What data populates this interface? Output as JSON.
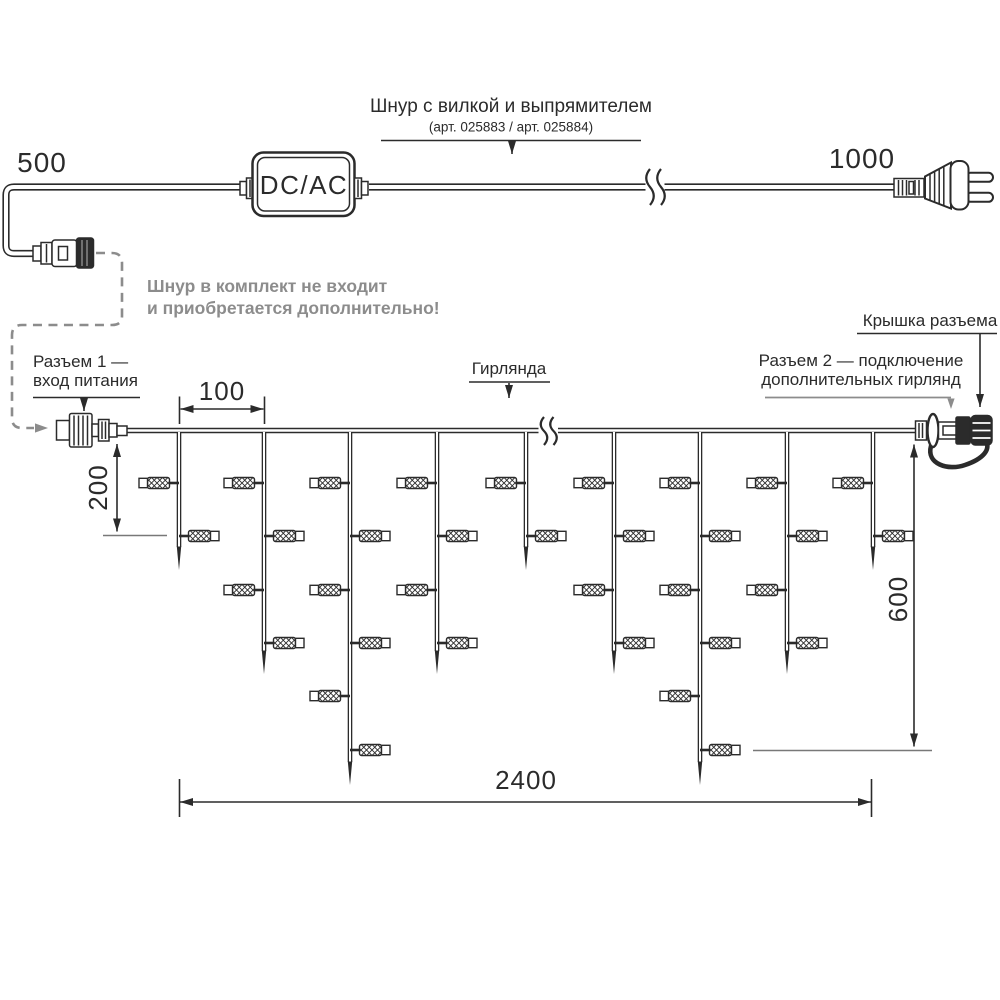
{
  "colors": {
    "ink": "#2b2b2b",
    "gray": "#8c8c8c",
    "extension_gray": "#787878",
    "background": "#ffffff"
  },
  "power_cord": {
    "length_left": "500",
    "length_right": "1000",
    "converter_label": "DC/AC",
    "title": "Шнур с вилкой и выпрямителем",
    "article": "(арт. 025883 / арт. 025884)",
    "note_line1": "Шнур в комплект не входит",
    "note_line2": "и приобретается дополнительно!"
  },
  "labels": {
    "connector1_line1": "Разъем 1 —",
    "connector1_line2": "вход питания",
    "garland": "Гирлянда",
    "connector2_line1": "Разъем 2 — подключение",
    "connector2_line2": "дополнительных гирлянд",
    "connector_cap": "Крышка разъема"
  },
  "dimensions": {
    "drop_spacing": "100",
    "first_drop_offset": "200",
    "curtain_height": "600",
    "curtain_width": "2400"
  },
  "garland": {
    "wire_y": 430.5,
    "drops": [
      {
        "x": 179,
        "type": "short"
      },
      {
        "x": 264,
        "type": "medium"
      },
      {
        "x": 350,
        "type": "long"
      },
      {
        "x": 437,
        "type": "medium"
      },
      {
        "x": 526,
        "type": "short"
      },
      {
        "x": 614,
        "type": "medium"
      },
      {
        "x": 700,
        "type": "long"
      },
      {
        "x": 787,
        "type": "medium"
      },
      {
        "x": 873,
        "type": "short"
      }
    ],
    "bulb_rows_y": [
      483,
      536,
      590,
      643,
      696,
      750
    ],
    "tip_y": {
      "short": 570,
      "medium": 674,
      "long": 785
    },
    "bulbs_per_type": {
      "short": 2,
      "medium": 4,
      "long": 6
    }
  }
}
